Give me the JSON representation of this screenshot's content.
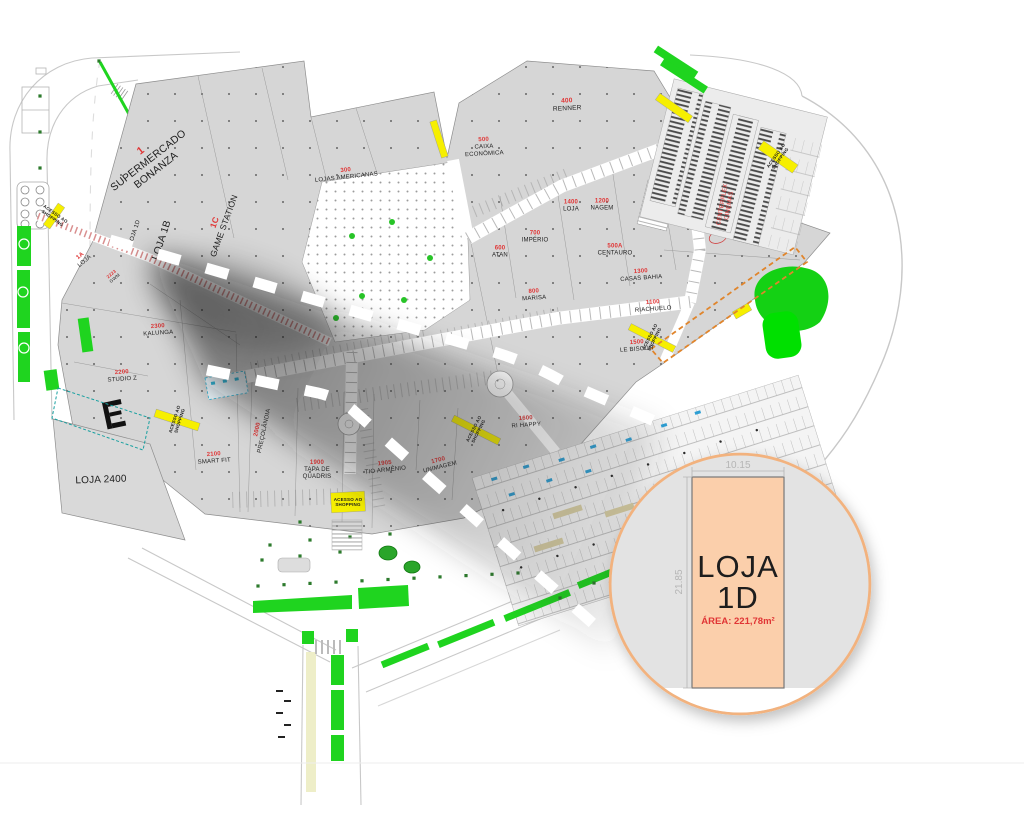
{
  "colors": {
    "building": "#d6d6d6",
    "building_edge": "#8d8d8d",
    "corridor": "#ffffff",
    "accent_green": "#1fd41f",
    "accent_green_dark": "#2c7a2c",
    "accent_yellow": "#f6ef00",
    "accent_orange": "#e0852c",
    "label_red": "#e03535",
    "label_black": "#1d1d1d",
    "circle_stroke": "#f2b27e",
    "store_fill": "#fbcfab",
    "dim_gray": "#b5b5b5",
    "car_blue": "#2e9fd4"
  },
  "callout": {
    "name_line1": "LOJA",
    "name_line2": "1D",
    "area": "ÁREA: 221,78m²",
    "width_dim": "10.15",
    "height_dim": "21.85"
  },
  "plan": {
    "labels": [
      {
        "num": "1",
        "name": "SUPERMERCADO\nBONANZA",
        "x": 148,
        "y": 160,
        "rot": -38,
        "size": 10.5
      },
      {
        "name": "LOJA 1D",
        "x": 134,
        "y": 232,
        "rot": -72,
        "size": 6
      },
      {
        "name": "LOJA 1B",
        "x": 161,
        "y": 240,
        "rot": -72,
        "size": 10
      },
      {
        "num": "1C",
        "name": "GAME STATION",
        "x": 219,
        "y": 224,
        "rot": -70,
        "size": 8.5
      },
      {
        "num": "300",
        "name": "LOJAS AMERICANAS",
        "x": 346,
        "y": 173,
        "rot": -6,
        "size": 6
      },
      {
        "num": "400",
        "name": "RENNER",
        "x": 567,
        "y": 104,
        "rot": -3,
        "size": 6.5
      },
      {
        "num": "500",
        "name": "CAIXA\nECONÔMICA",
        "x": 484,
        "y": 146,
        "rot": -3,
        "size": 6
      },
      {
        "num": "1400",
        "name": "LOJA",
        "x": 571,
        "y": 205,
        "rot": 0,
        "size": 6
      },
      {
        "num": "1200",
        "name": "NAGEM",
        "x": 602,
        "y": 204,
        "rot": 0,
        "size": 6
      },
      {
        "num": "700",
        "name": "IMPÉRIO",
        "x": 535,
        "y": 236,
        "rot": 0,
        "size": 6
      },
      {
        "num": "600",
        "name": "ATAN",
        "x": 500,
        "y": 251,
        "rot": 0,
        "size": 6
      },
      {
        "num": "500A",
        "name": "CENTAURO",
        "x": 615,
        "y": 249,
        "rot": 0,
        "size": 6
      },
      {
        "num": "1300",
        "name": "CASAS BAHIA",
        "x": 641,
        "y": 274,
        "rot": -4,
        "size": 6
      },
      {
        "num": "800",
        "name": "MARISA",
        "x": 534,
        "y": 294,
        "rot": -4,
        "size": 6
      },
      {
        "num": "1100",
        "name": "RIACHUELO",
        "x": 653,
        "y": 305,
        "rot": -4,
        "size": 6
      },
      {
        "num": "1500",
        "name": "LE BISCUIT",
        "x": 637,
        "y": 345,
        "rot": -4,
        "size": 6
      },
      {
        "num": "1600",
        "name": "RI HAPPY",
        "x": 526,
        "y": 421,
        "rot": -4,
        "size": 6
      },
      {
        "num": "2300",
        "name": "KALUNGA",
        "x": 158,
        "y": 329,
        "rot": -4,
        "size": 6
      },
      {
        "num": "2200",
        "name": "STUDIO Z",
        "x": 122,
        "y": 375,
        "rot": -4,
        "size": 6
      },
      {
        "num": "2100",
        "name": "SMART FIT",
        "x": 214,
        "y": 457,
        "rot": -4,
        "size": 6
      },
      {
        "num": "2000",
        "name": "PREÇOLÂNDIA",
        "x": 260,
        "y": 430,
        "rot": -78,
        "size": 6
      },
      {
        "num": "1900",
        "name": "TAPA DE\nQUADRIS",
        "x": 317,
        "y": 469,
        "rot": 0,
        "size": 6
      },
      {
        "num": "1905",
        "name": "TIO ARMÊNIO",
        "x": 385,
        "y": 466,
        "rot": -6,
        "size": 6
      },
      {
        "num": "1700",
        "name": "UNIMAGEM",
        "x": 439,
        "y": 463,
        "rot": -14,
        "size": 6
      },
      {
        "name": "LOJA 2400",
        "x": 101,
        "y": 479,
        "rot": -2,
        "size": 10
      },
      {
        "num": "1A",
        "name": "LOJA",
        "x": 82,
        "y": 258,
        "rot": -40,
        "size": 6
      },
      {
        "num": "2223",
        "name": "GWM",
        "x": 113,
        "y": 276,
        "rot": -40,
        "size": 4.5
      },
      {
        "name": "CENTERPLEX\nCINEMAS",
        "x": 725,
        "y": 205,
        "rot": -80,
        "size": 6,
        "color": "red"
      },
      {
        "name": "ACESSO AO\nSHOPPING",
        "x": 348,
        "y": 502,
        "rot": 0,
        "size": 4.5,
        "style": "access"
      },
      {
        "name": "ACESSO AO\nSHOPPING",
        "x": 778,
        "y": 157,
        "rot": -55,
        "size": 4.5,
        "style": "access"
      },
      {
        "name": "ACESSO AO\nSHOPPING",
        "x": 54,
        "y": 216,
        "rot": 35,
        "size": 4.5,
        "style": "access"
      },
      {
        "name": "ACESSO AO\nSHOPPING",
        "x": 652,
        "y": 338,
        "rot": -63,
        "size": 4.5,
        "style": "access"
      },
      {
        "name": "ACESSO AO\nSHOPPING",
        "x": 476,
        "y": 430,
        "rot": -63,
        "size": 4.5,
        "style": "access"
      },
      {
        "name": "ACESSO AO\nSHOPPING",
        "x": 177,
        "y": 420,
        "rot": -72,
        "size": 4.5,
        "style": "access"
      }
    ]
  }
}
